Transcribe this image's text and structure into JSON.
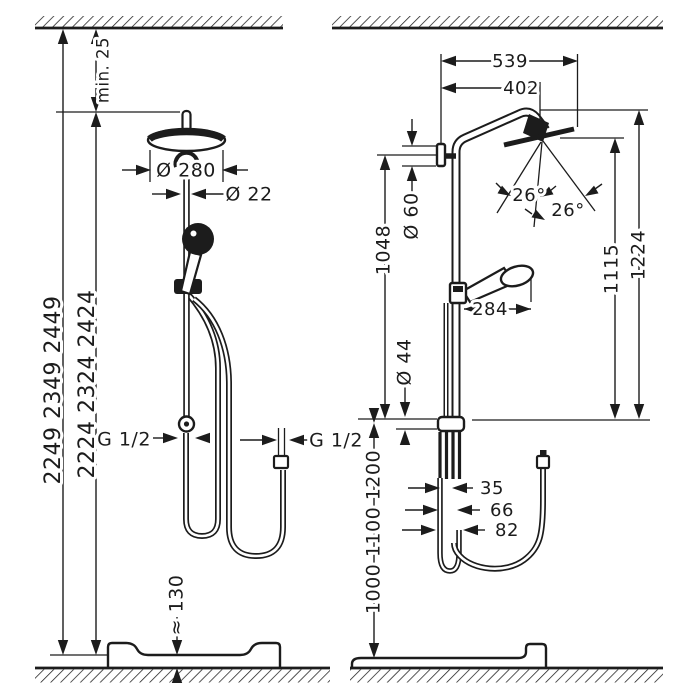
{
  "figure": {
    "background": "#ffffff",
    "line_color": "#1c1c1c",
    "description": "Shower pipe installation dimension drawing, front view and side view"
  },
  "left_view": {
    "dim_total_height_outer": "2249 2349 2449",
    "dim_total_height_inner": "2224 2324 2424",
    "dim_ceiling_clearance": "min. 25",
    "dim_head_diameter": "Ø 280",
    "dim_pipe_diameter": "Ø 22",
    "dim_supply_connection": "G 1/2",
    "dim_hose_connection": "G 1/2",
    "dim_tray_height": "≈ 130"
  },
  "right_view": {
    "dim_depth_total": "539",
    "dim_depth_arm": "402",
    "dim_escutcheon_diameter": "Ø 60",
    "dim_bracket_to_valve": "1048",
    "dim_spray_angle_left": "26°",
    "dim_spray_angle_right": "26°",
    "dim_head_height_inner": "1115",
    "dim_head_height_outer": "1224",
    "dim_handshower_reach": "284",
    "dim_valve_diameter": "Ø 44",
    "dim_valve_heights": "1000 1100 1200",
    "dim_width_inner": "35",
    "dim_width_mid": "66",
    "dim_width_outer": "82"
  }
}
